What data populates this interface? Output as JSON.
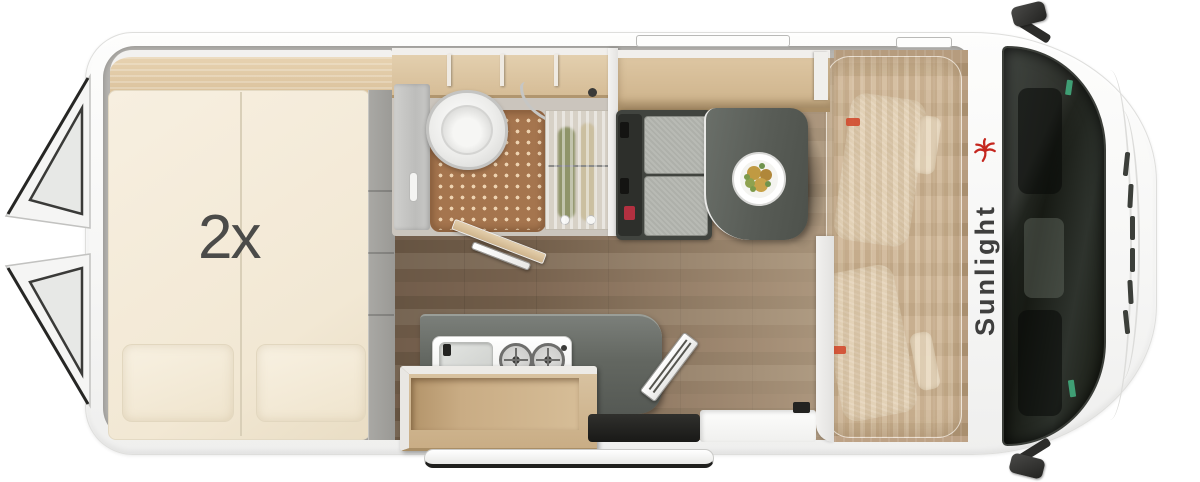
{
  "floorplan": {
    "bed_label": "2x",
    "brand": "Sunlight",
    "colors": {
      "accent_red": "#c5271f",
      "marker_red": "#d14a2e",
      "mattress_cream": "#f4ecda",
      "furniture_wood": "#d9c29e",
      "floor_walnut": "#7b6450",
      "counter_gray": "#5d615c",
      "table_gray": "#585c56",
      "bath_floor": "#cbc5bd",
      "shower_mat_brown": "#a5754e",
      "glass_dark": "#171a14",
      "body_white": "#f7f7f6"
    }
  }
}
